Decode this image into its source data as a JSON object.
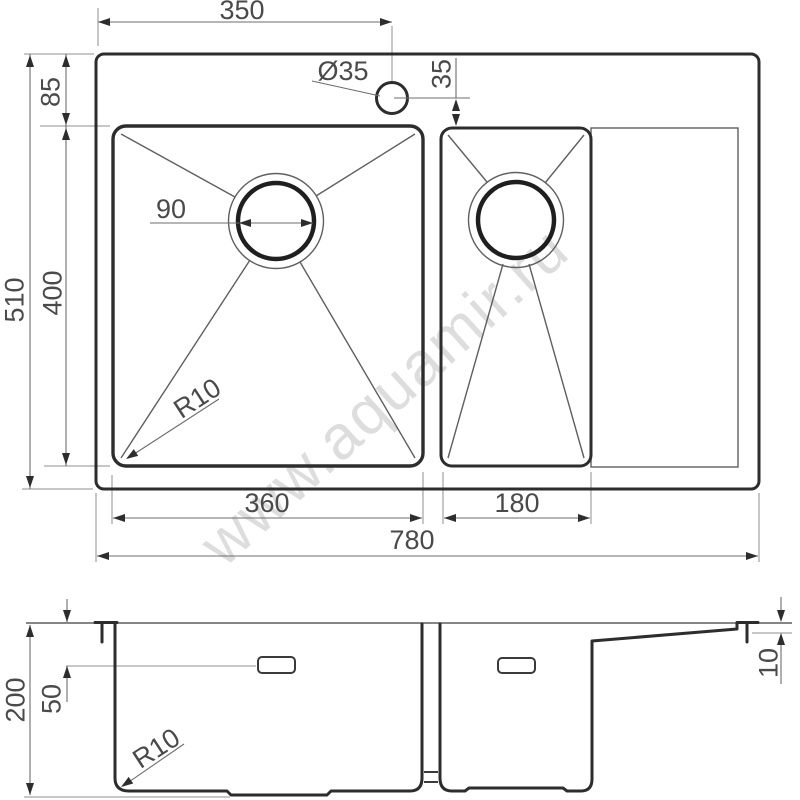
{
  "watermark": {
    "text": "www.aquamir.ru"
  },
  "colors": {
    "line": "#2d2d2d",
    "thin_line": "#5f5f5f",
    "dim_text": "#4a4a4a",
    "watermark": "#c3c3c3",
    "background": "#ffffff"
  },
  "top_view": {
    "dims": {
      "faucet_center_from_left": "350",
      "faucet_hole_diameter": "Ø35",
      "faucet_to_bowl": "35",
      "rim_to_bowl": "85",
      "overall_depth": "510",
      "bowl_depth": "400",
      "drain_diameter": "90",
      "corner_radius": "R10",
      "left_bowl_width": "360",
      "right_bowl_width": "180",
      "overall_width": "780"
    }
  },
  "side_view": {
    "dims": {
      "overall_height": "200",
      "overflow_offset": "50",
      "corner_radius": "R10",
      "rim_lip_height": "10"
    }
  }
}
